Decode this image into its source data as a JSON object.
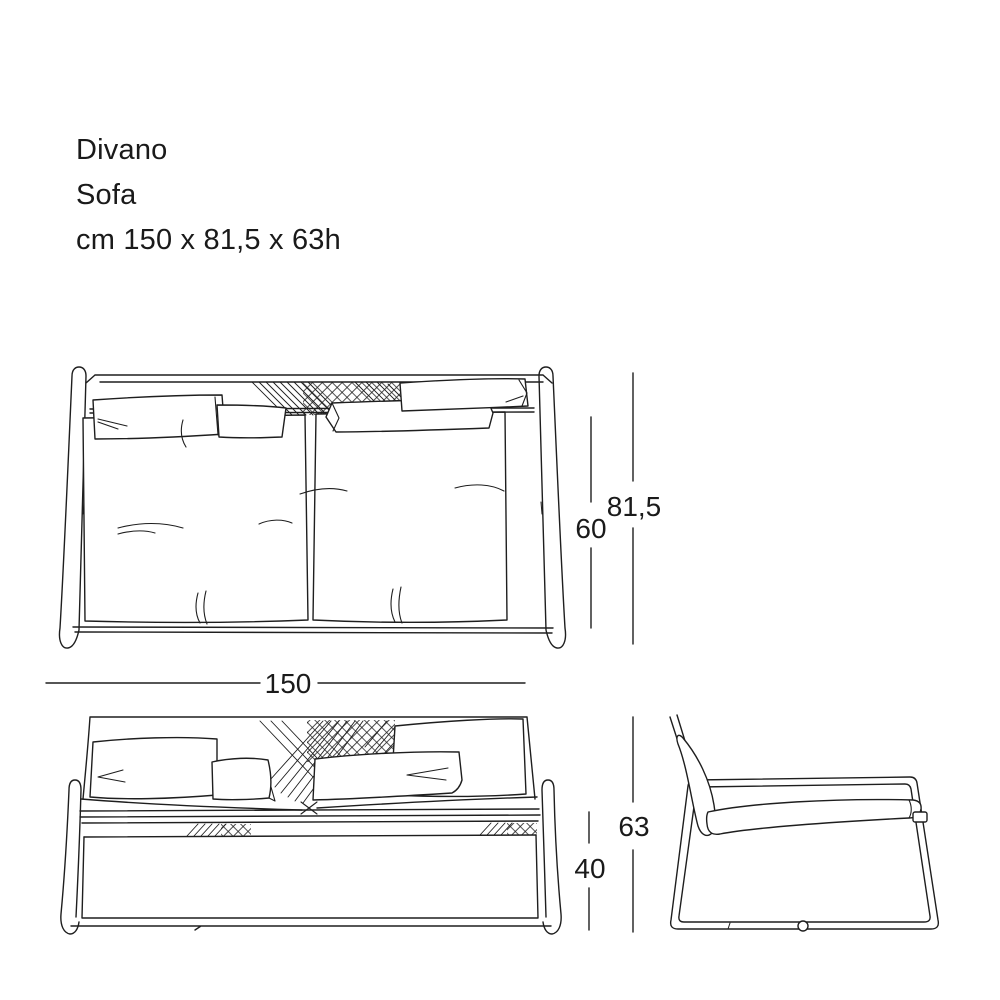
{
  "title": {
    "line1": "Divano",
    "line2": "Sofa",
    "line3": "cm 150 x 81,5 x 63h"
  },
  "dimension_labels": {
    "width": "150",
    "seat_depth": "60",
    "total_depth": "81,5",
    "total_height": "63",
    "seat_height": "40"
  },
  "colors": {
    "line_color": "#1e1e1e",
    "background": "#ffffff",
    "text_color": "#1a1a1a"
  }
}
